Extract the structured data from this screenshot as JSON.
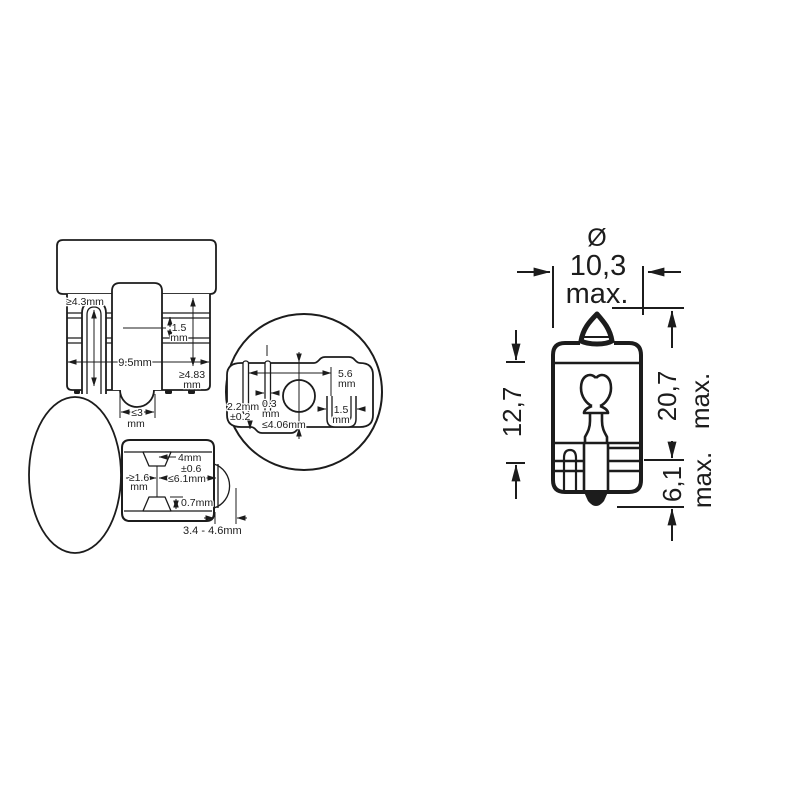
{
  "colors": {
    "ink": "#1c1c1c",
    "background": "#ffffff"
  },
  "views": {
    "front_view": {
      "wire_length": "≥4.3mm",
      "groove_pitch_value": "1.5",
      "groove_pitch_unit": "mm",
      "base_width": "9.5mm",
      "seal_depth_value": "≥4.83",
      "seal_depth_unit": "mm",
      "bump_width_value": "≤3",
      "bump_width_unit": "mm"
    },
    "bottom_view": {
      "contact_span_value": "5.6",
      "contact_span_unit": "mm",
      "contact_thickness_value": "0.3",
      "contact_thickness_unit": "mm",
      "contact_offset_value": "2.2mm",
      "contact_offset_tolerance": "±0.2",
      "wedge_thickness": "≤4.06mm",
      "slot_width_value": "1.5",
      "slot_width_unit": "mm"
    },
    "side_view": {
      "notch_width_value": "4mm",
      "notch_width_tolerance": "±0.6",
      "edge_distance_value": "≥1.6",
      "edge_distance_unit": "mm",
      "notch_to_seal": "≤6.1mm",
      "notch_depth": "0.7mm",
      "seal_protrusion": "3.4 - 4.6mm"
    },
    "outline_view": {
      "diameter_symbol": "Ø",
      "diameter_value": "10,3",
      "diameter_qualifier": "max.",
      "glass_length": "12,7",
      "overall_length_value": "20,7",
      "overall_length_qualifier": "max.",
      "base_height_value": "6,1",
      "base_height_qualifier": "max."
    }
  }
}
